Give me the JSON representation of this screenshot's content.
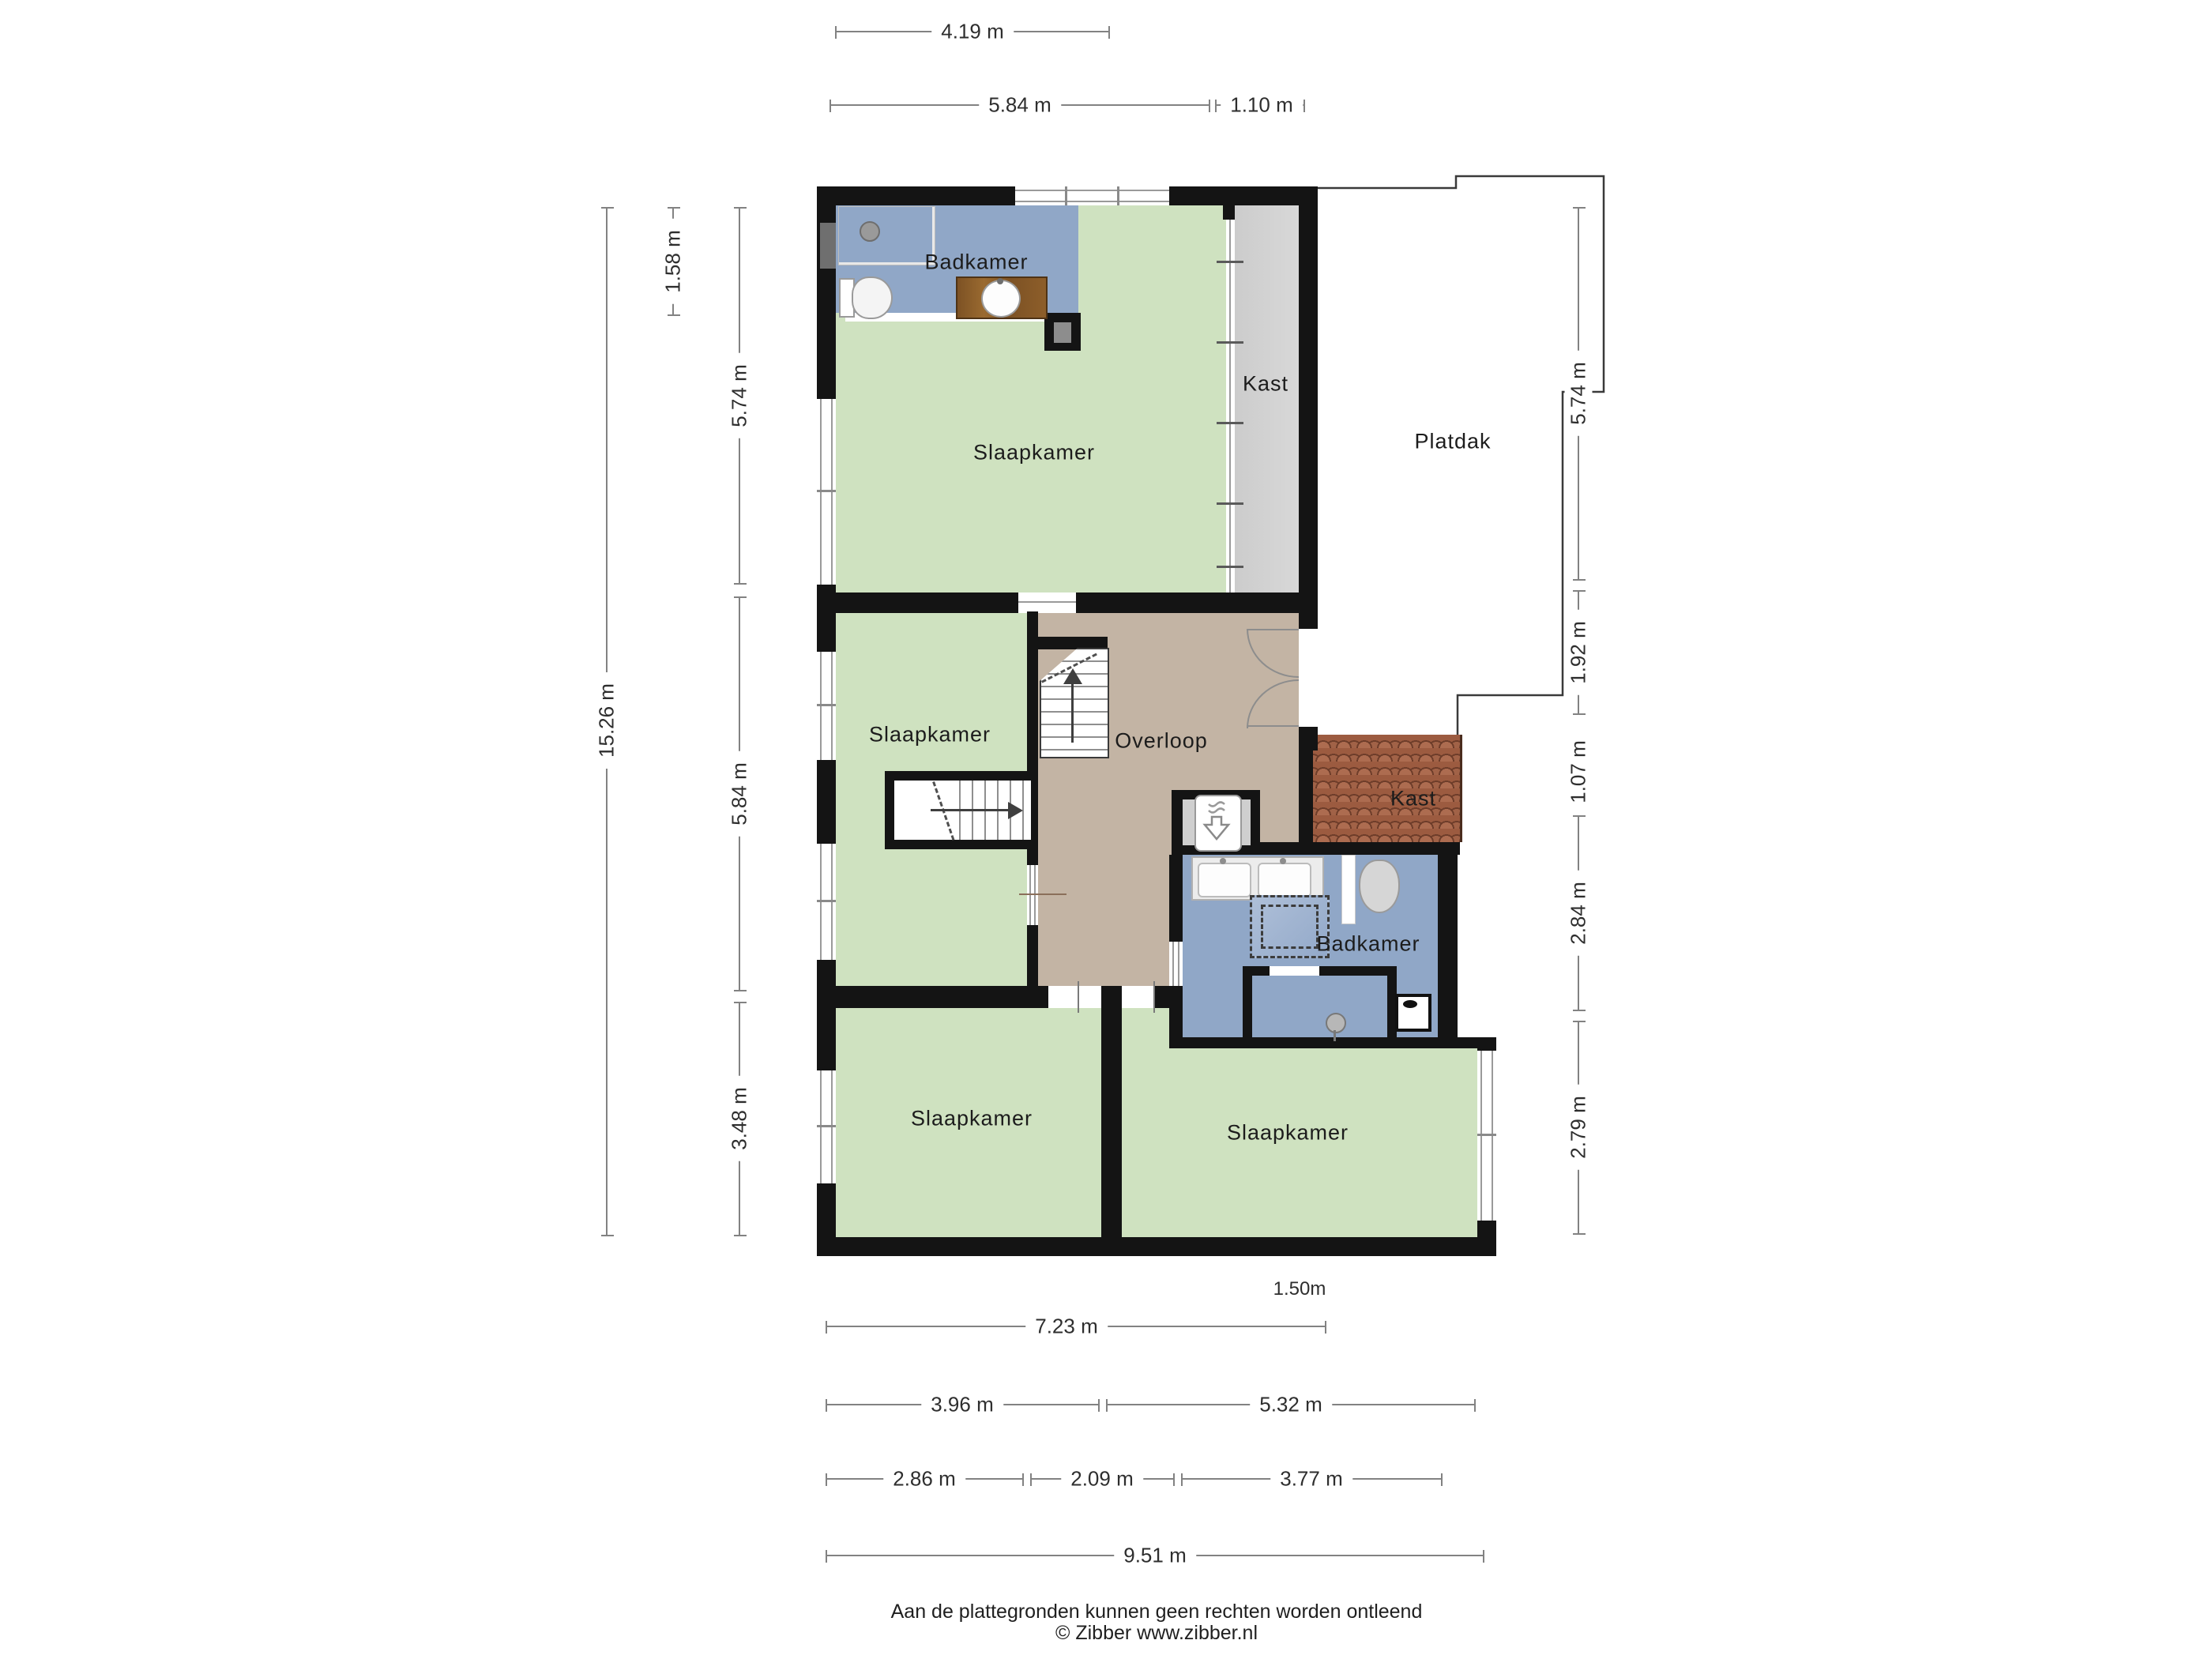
{
  "title": "Verdieping plattegrond",
  "rooms": {
    "badkamer_top": {
      "label": "Badkamer",
      "fill": "#90a7c7"
    },
    "slaapkamer_top": {
      "label": "Slaapkamer",
      "fill": "#cfe2c0"
    },
    "kast_top": {
      "label": "Kast",
      "fill": "#d8d8d8"
    },
    "platdak": {
      "label": "Platdak",
      "fill": "#ffffff"
    },
    "slaapkamer_mid": {
      "label": "Slaapkamer",
      "fill": "#cfe2c0"
    },
    "overloop": {
      "label": "Overloop",
      "fill": "#c3b4a4"
    },
    "kast_mid": {
      "label": "Kast",
      "fill": "#9c5b40"
    },
    "badkamer_mid": {
      "label": "Badkamer",
      "fill": "#90a7c7"
    },
    "slaapkamer_bl": {
      "label": "Slaapkamer",
      "fill": "#cfe2c0"
    },
    "slaapkamer_br": {
      "label": "Slaapkamer",
      "fill": "#cfe2c0"
    }
  },
  "dimensions": {
    "top": [
      {
        "label": "4.19 m"
      },
      {
        "label": "5.84 m"
      },
      {
        "label": "1.10 m"
      }
    ],
    "left": [
      {
        "label": "15.26 m"
      },
      {
        "label": "1.58 m"
      },
      {
        "label": "5.74 m"
      },
      {
        "label": "5.84 m"
      },
      {
        "label": "3.48 m"
      }
    ],
    "right": [
      {
        "label": "5.74 m"
      },
      {
        "label": "1.92 m"
      },
      {
        "label": "1.07 m"
      },
      {
        "label": "2.84 m"
      },
      {
        "label": "2.79 m"
      }
    ],
    "bottom": [
      {
        "label": "7.23 m"
      },
      {
        "label": "3.96 m"
      },
      {
        "label": "5.32 m"
      },
      {
        "label": "2.86 m"
      },
      {
        "label": "2.09 m"
      },
      {
        "label": "3.77 m"
      },
      {
        "label": "9.51 m"
      }
    ],
    "height_note": "1.50m"
  },
  "footer": {
    "disclaimer": "Aan de plattegronden kunnen geen rechten worden ontleend",
    "credit": "© Zibber www.zibber.nl"
  },
  "colors": {
    "wall": "#141414",
    "bedroom": "#cfe2c0",
    "bathroom": "#90a7c7",
    "hall": "#c3b4a4",
    "closet": "#d8d8d8",
    "roof_tiles": "#9c5b40",
    "dimension_line": "#828282"
  }
}
